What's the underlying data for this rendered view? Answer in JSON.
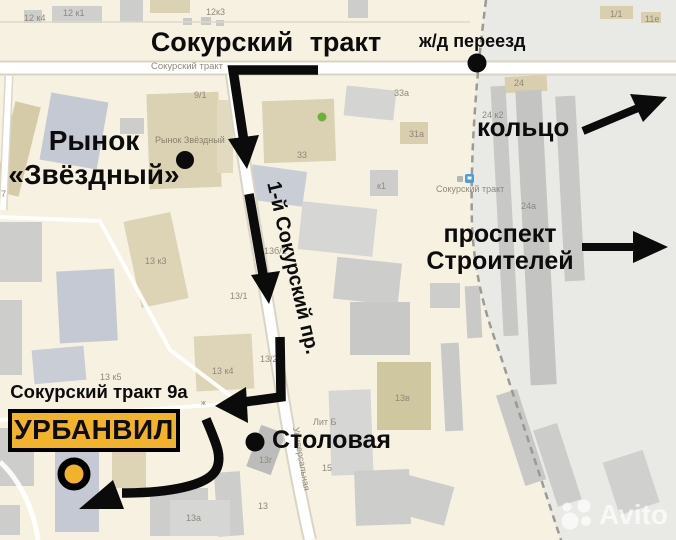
{
  "annotations": {
    "title": "Сокурский тракт",
    "railway_crossing": "ж/д переезд",
    "ring": "кольцо",
    "prospect": "проспект Строителей",
    "prospect_line1": "проспект",
    "prospect_line2": "Строителей",
    "market_line1": "Рынок",
    "market_line2": "«Звёздный»",
    "street_rotated": "1-й Сокурский пр.",
    "address": "Сокурский тракт 9а",
    "destination": "УРБАНВИЛ",
    "canteen": "Столовая"
  },
  "map_labels": {
    "road_main": "Сокурский тракт",
    "stop_name": "Сокурский тракт",
    "street_universalnaya": "Универсальная",
    "poi_market": "Рынок Звёздный",
    "rail_symbol": "ж"
  },
  "building_labels": [
    "12 к4",
    "12 к1",
    "12к3",
    "1/1",
    "11е",
    "9/1",
    "33а",
    "31а",
    "33",
    "к1",
    "24",
    "24 к2",
    "24а",
    "13 к3",
    "13б/2",
    "13/1",
    "13/2",
    "13 к4",
    "13 к5",
    "Лит Б",
    "13г",
    "15",
    "13",
    "13а",
    "13в",
    "7"
  ],
  "watermark": {
    "brand": "Avito"
  },
  "colors": {
    "map_background": "#F6F1E1",
    "industrial_zone": "#E9E9E6",
    "accent_yellow": "#F2B32A",
    "annotation_black": "#0C0C0C",
    "stop_icon_blue": "#4D9BDB",
    "poi_green": "#6FAF3B",
    "road_white": "#FFFFFF"
  }
}
